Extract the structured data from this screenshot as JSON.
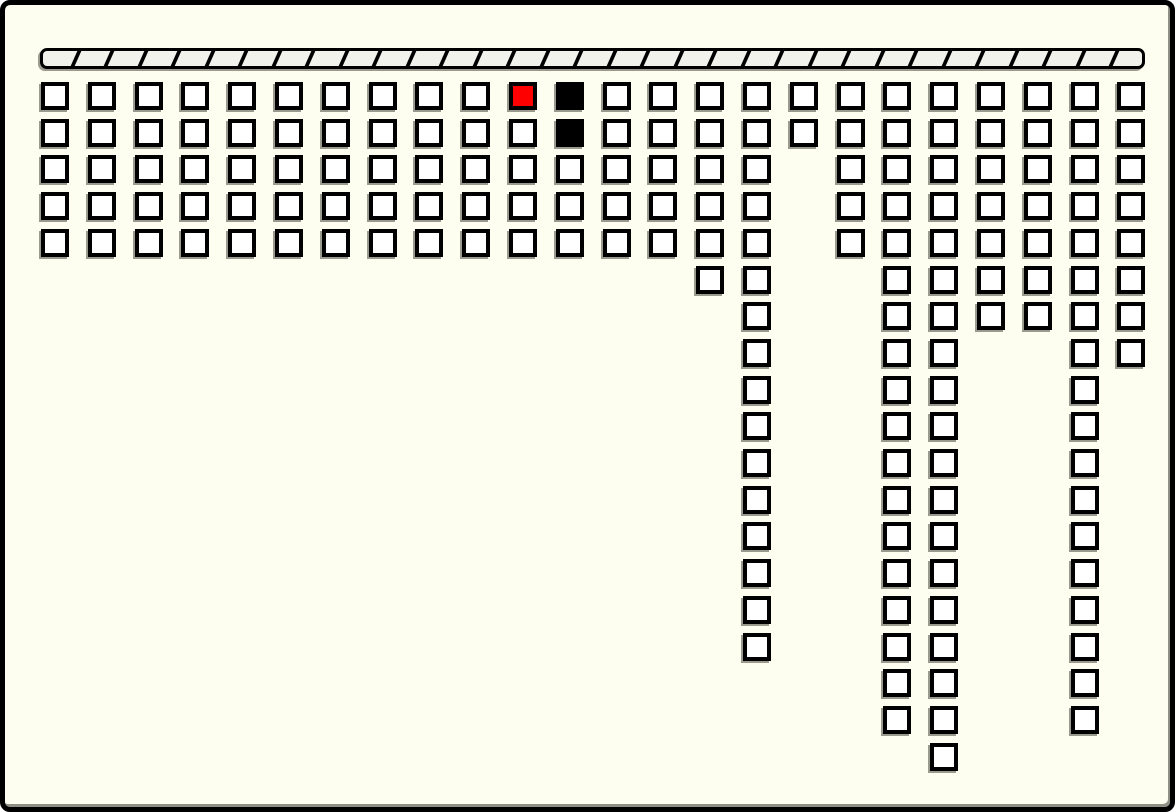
{
  "window": {
    "width": 1175,
    "height": 812,
    "background": "#FDFDF0",
    "border_color": "#000000",
    "border_width": 5,
    "corner_radius": 10,
    "edge_shadow_color": "#8F8F86"
  },
  "striped_bar": {
    "x": 35,
    "y": 43,
    "width": 1105,
    "height": 21,
    "fill": "#F2F2EC",
    "border_color": "#000000",
    "border_width": 3,
    "corner_radius": 7,
    "shadow_color": "#9A9A8F",
    "stripe_color": "#000000",
    "stripe_width": 4,
    "stripe_pitch": 33.5,
    "stripe_skew_deg": -24,
    "segment_count": 33
  },
  "grid": {
    "origin_x": 36,
    "origin_y": 77,
    "pitch_x": 46.8,
    "pitch_y": 36.7,
    "cell_width": 28,
    "cell_height": 28,
    "cell_border_width": 4,
    "cell_border_color": "#000000",
    "cell_fill": "#FFFFFF",
    "shadow_color": "#9A9A8F",
    "shadow_dx": -2,
    "shadow_dy": 2,
    "total_cells": 176,
    "columns": [
      {
        "col": 0,
        "rows_from": 0,
        "rows_to": 4
      },
      {
        "col": 1,
        "rows_from": 0,
        "rows_to": 4
      },
      {
        "col": 2,
        "rows_from": 0,
        "rows_to": 4
      },
      {
        "col": 3,
        "rows_from": 0,
        "rows_to": 4
      },
      {
        "col": 4,
        "rows_from": 0,
        "rows_to": 4
      },
      {
        "col": 5,
        "rows_from": 0,
        "rows_to": 4
      },
      {
        "col": 6,
        "rows_from": 0,
        "rows_to": 4
      },
      {
        "col": 7,
        "rows_from": 0,
        "rows_to": 4
      },
      {
        "col": 8,
        "rows_from": 0,
        "rows_to": 4
      },
      {
        "col": 9,
        "rows_from": 0,
        "rows_to": 4
      },
      {
        "col": 10,
        "rows_from": 0,
        "rows_to": 4
      },
      {
        "col": 11,
        "rows_from": 0,
        "rows_to": 4
      },
      {
        "col": 12,
        "rows_from": 0,
        "rows_to": 4
      },
      {
        "col": 13,
        "rows_from": 0,
        "rows_to": 4
      },
      {
        "col": 14,
        "rows_from": 0,
        "rows_to": 5
      },
      {
        "col": 15,
        "rows_from": 0,
        "rows_to": 15
      },
      {
        "col": 16,
        "rows_from": 0,
        "rows_to": 1
      },
      {
        "col": 17,
        "rows_from": 0,
        "rows_to": 4
      },
      {
        "col": 18,
        "rows_from": 0,
        "rows_to": 17
      },
      {
        "col": 19,
        "rows_from": 0,
        "rows_to": 18
      },
      {
        "col": 20,
        "rows_from": 0,
        "rows_to": 6
      },
      {
        "col": 21,
        "rows_from": 0,
        "rows_to": 6
      },
      {
        "col": 22,
        "rows_from": 0,
        "rows_to": 17
      },
      {
        "col": 23,
        "rows_from": 0,
        "rows_to": 7
      }
    ],
    "filled_cells": [
      {
        "col": 10,
        "row": 0,
        "fill": "#FF0000",
        "name": "red-cell"
      },
      {
        "col": 11,
        "row": 0,
        "fill": "#000000",
        "name": "black-cell"
      },
      {
        "col": 11,
        "row": 1,
        "fill": "#000000",
        "name": "black-cell"
      }
    ]
  }
}
